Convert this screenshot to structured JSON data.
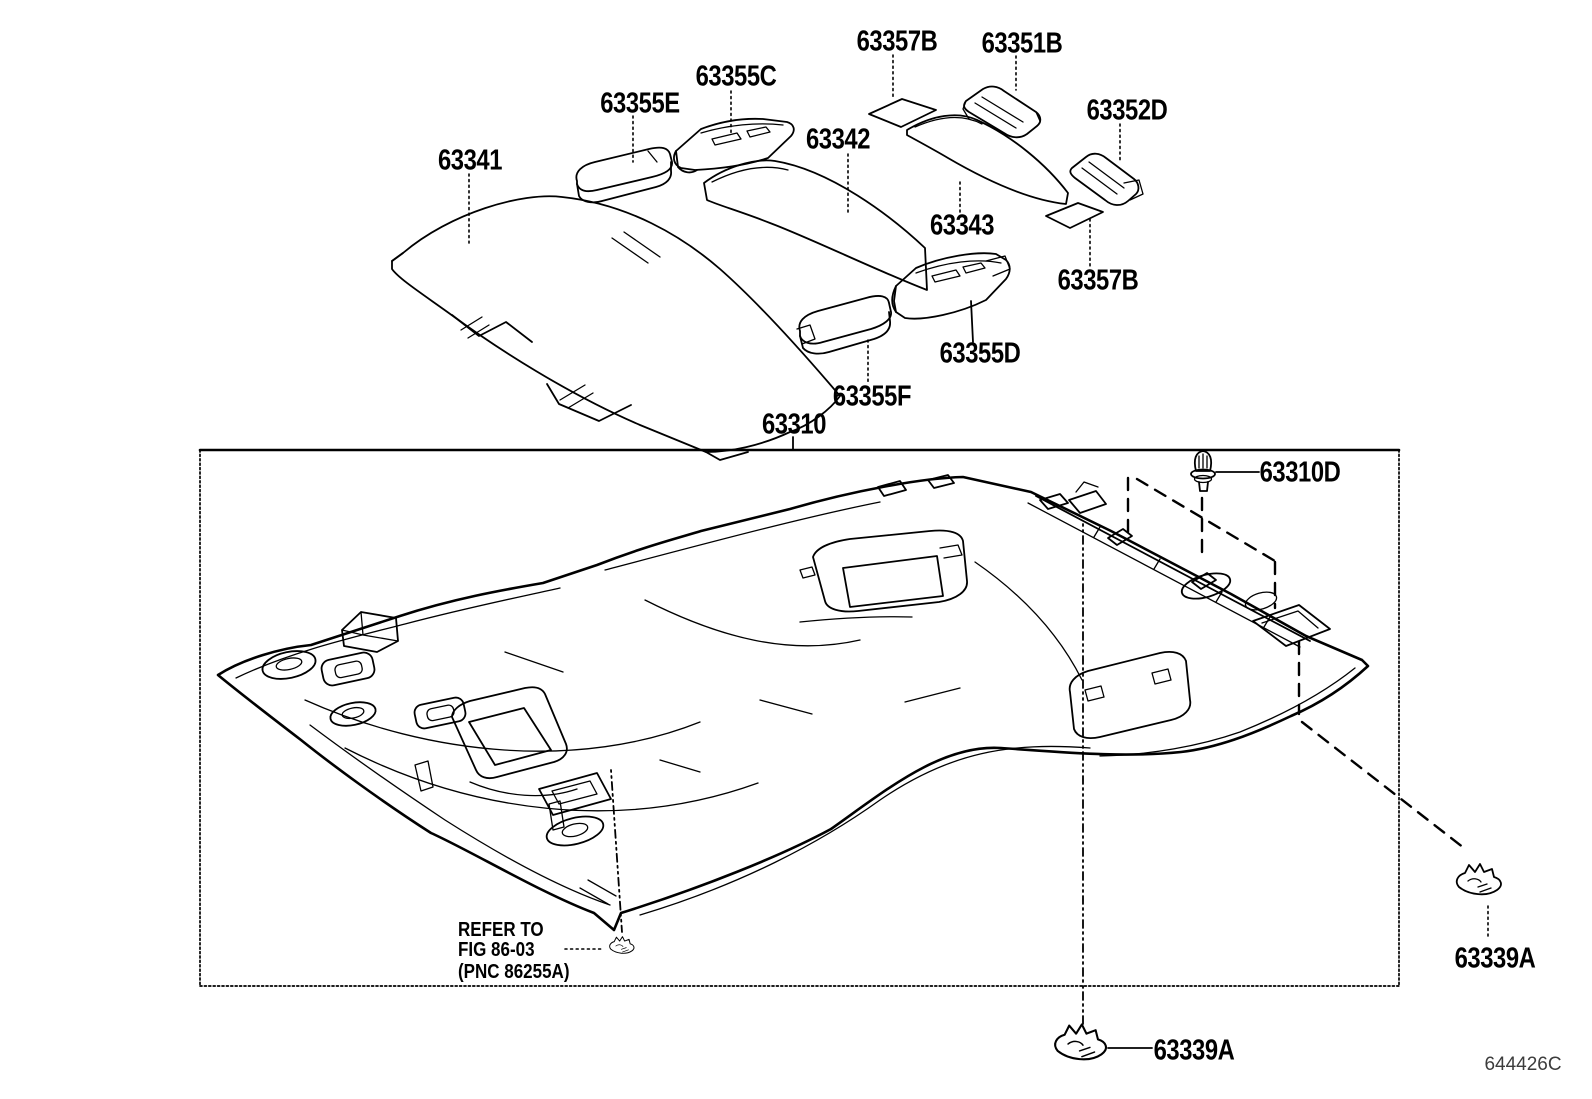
{
  "diagram": {
    "title_code": "644426C",
    "background": "#ffffff",
    "line_color": "#000000",
    "part_labels": [
      {
        "id": "63357B-top",
        "text": "63357B"
      },
      {
        "id": "63351B",
        "text": "63351B"
      },
      {
        "id": "63355C",
        "text": "63355C"
      },
      {
        "id": "63355E",
        "text": "63355E"
      },
      {
        "id": "63352D",
        "text": "63352D"
      },
      {
        "id": "63342",
        "text": "63342"
      },
      {
        "id": "63341",
        "text": "63341"
      },
      {
        "id": "63343",
        "text": "63343"
      },
      {
        "id": "63357B-mid",
        "text": "63357B"
      },
      {
        "id": "63355D",
        "text": "63355D"
      },
      {
        "id": "63355F",
        "text": "63355F"
      },
      {
        "id": "63310",
        "text": "63310"
      },
      {
        "id": "63310D",
        "text": "63310D"
      },
      {
        "id": "63339A-right",
        "text": "63339A"
      },
      {
        "id": "63339A-bottom",
        "text": "63339A"
      }
    ],
    "note": {
      "line1": "REFER TO",
      "line2": "FIG 86-03",
      "line3": "(PNC 86255A)"
    }
  }
}
